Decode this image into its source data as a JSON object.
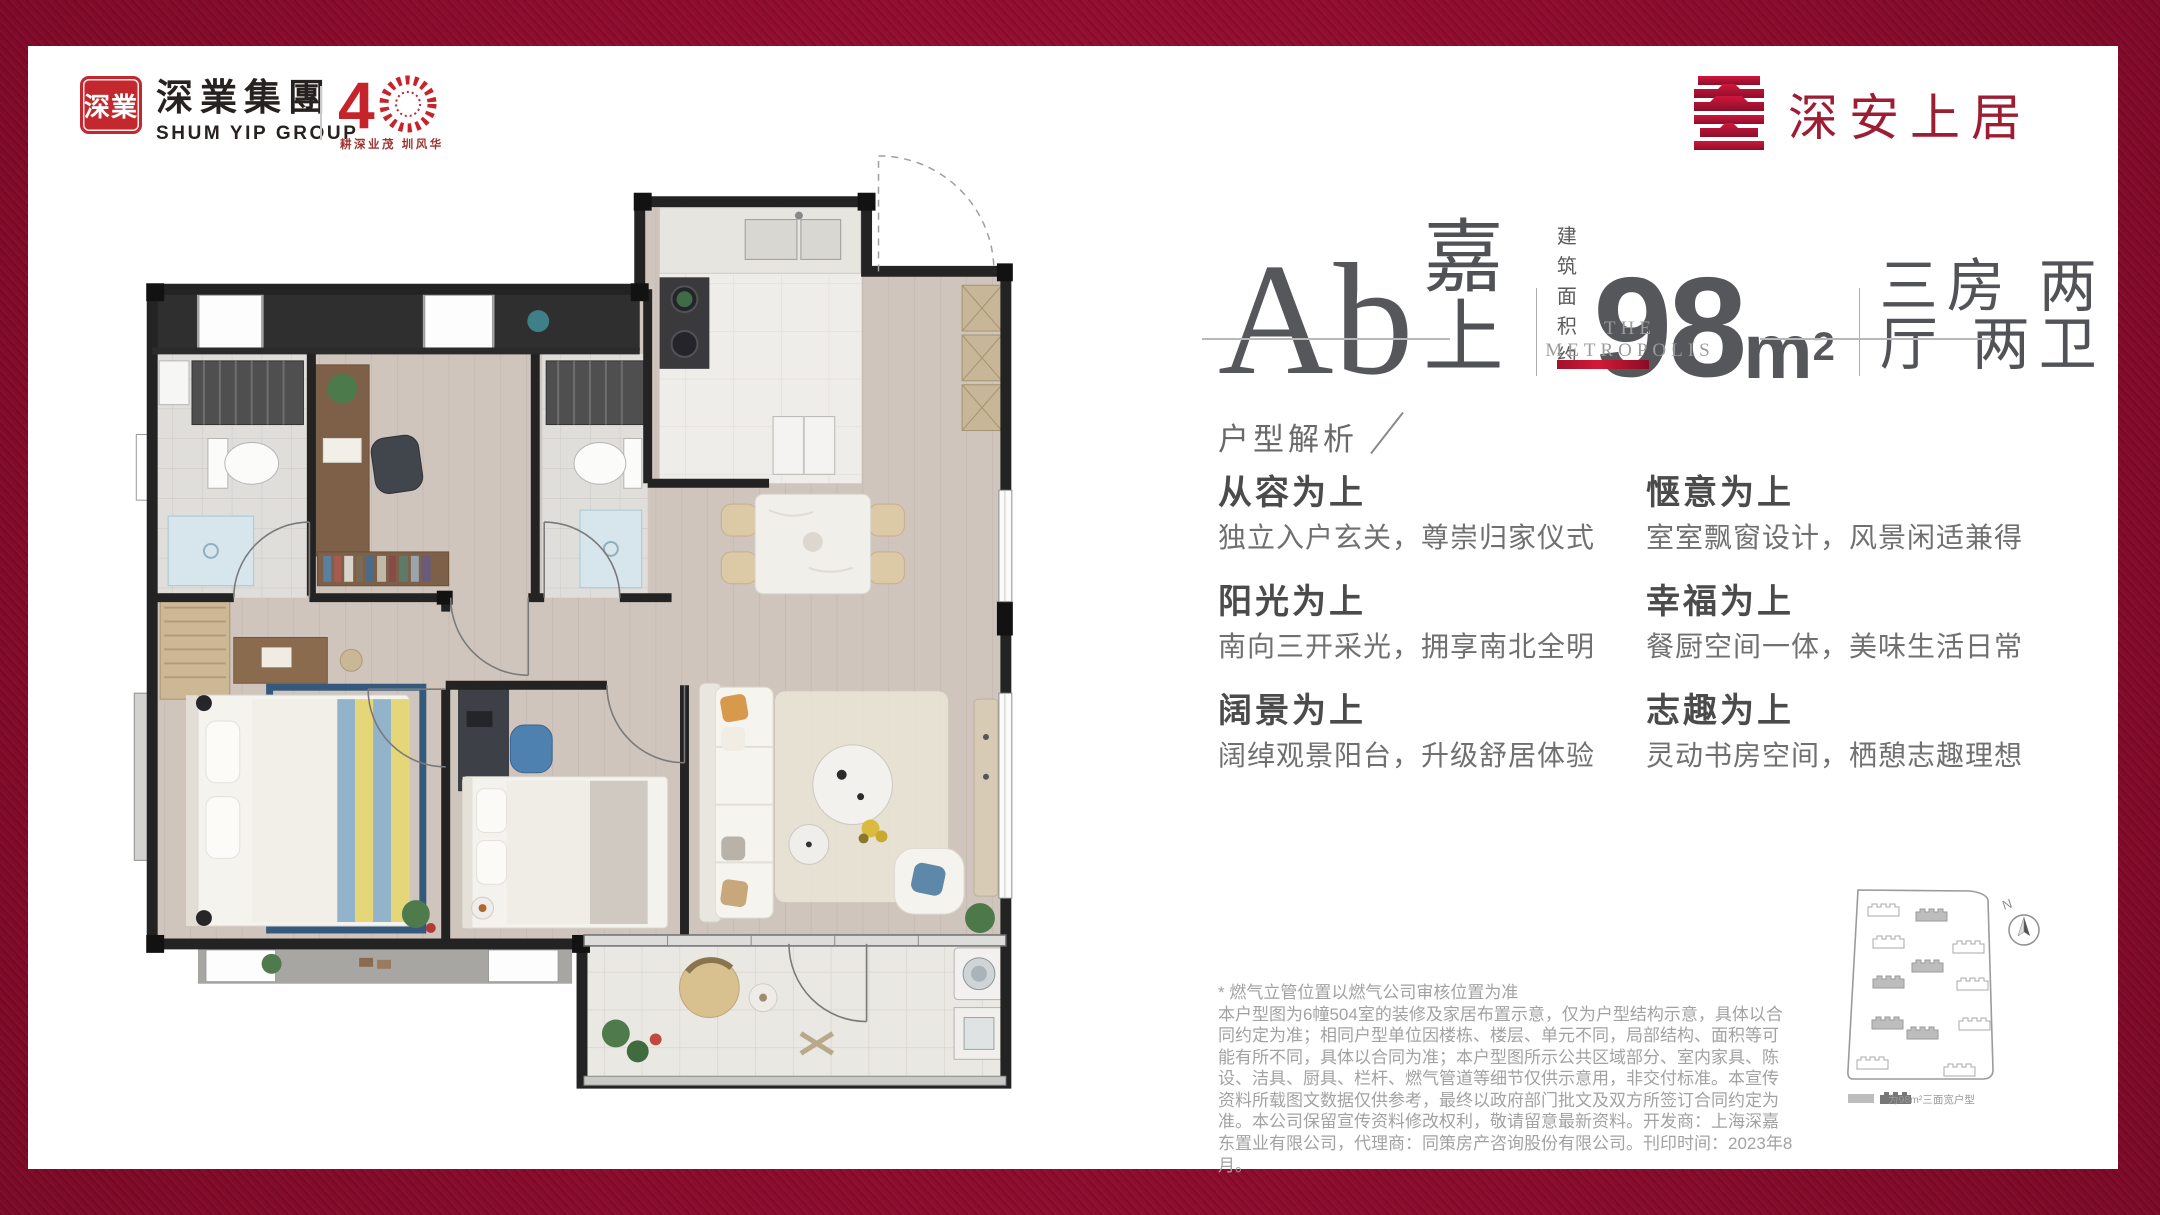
{
  "header": {
    "shumyip": {
      "seal_text": "深業",
      "name_cn": "深業集團",
      "name_en": "SHUM YIP GROUP",
      "anniversary_number": "4",
      "anniversary_tagline": "耕深业茂 圳风华"
    },
    "brand": {
      "name": "深安上居"
    }
  },
  "title": {
    "unit_name_serif": "Ab",
    "unit_name_cn": "嘉上",
    "area_label_line1": "建 筑",
    "area_label_line2": "面积约",
    "area_value": "98",
    "area_unit": "m",
    "area_sup": "2",
    "layout": "三房 两厅 两卫",
    "sub_brand_line1": "THE",
    "sub_brand_line2": "METROPOLIS"
  },
  "analysis": {
    "heading": "户型解析",
    "features": [
      {
        "title": "从容为上",
        "desc": "独立入户玄关，尊崇归家仪式"
      },
      {
        "title": "惬意为上",
        "desc": "室室飘窗设计，风景闲适兼得"
      },
      {
        "title": "阳光为上",
        "desc": "南向三开采光，拥享南北全明"
      },
      {
        "title": "幸福为上",
        "desc": "餐厨空间一体，美味生活日常"
      },
      {
        "title": "阔景为上",
        "desc": "阔绰观景阳台，升级舒居体验"
      },
      {
        "title": "志趣为上",
        "desc": "灵动书房空间，栖憩志趣理想"
      }
    ]
  },
  "disclaimer": {
    "note": "* 燃气立管位置以燃气公司审核位置为准",
    "body": "本户型图为6幢504室的装修及家居布置示意，仅为户型结构示意，具体以合同约定为准；相同户型单位因楼栋、楼层、单元不同，局部结构、面积等可能有所不同，具体以合同为准；本户型图所示公共区域部分、室内家具、陈设、洁具、厨具、栏杆、燃气管道等细节仅供示意用，非交付标准。本宣传资料所载图文数据仅供参考，最终以政府部门批文及双方所签订合同约定为准。本公司保留宣传资料修改权利，敬请留意最新资料。开发商：上海深嘉东置业有限公司，代理商：同策房产咨询股份有限公司。刊印时间：2023年8月。"
  },
  "siteplan": {
    "compass_label": "N",
    "legend_text": "为98m²三面宽户型"
  },
  "colors": {
    "frame_red": "#8E0C2E",
    "brand_red": "#C2282E",
    "logo_dark_red": "#9D1D33",
    "accent_bar": "#C51733",
    "title_gray": "#55565A"
  }
}
